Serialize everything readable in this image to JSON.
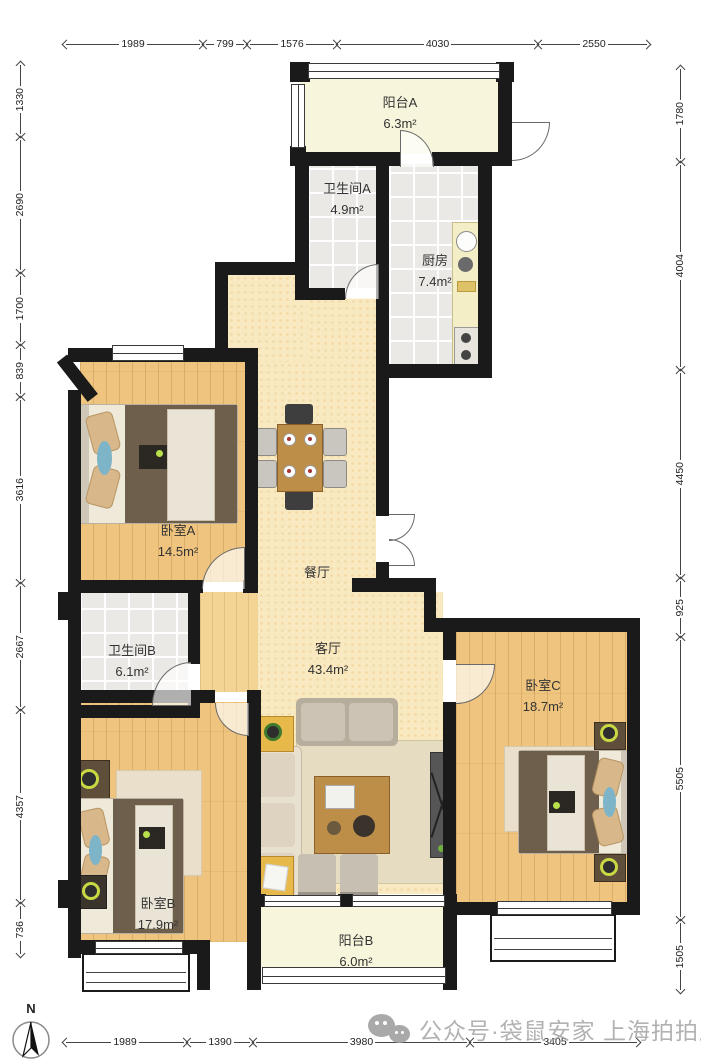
{
  "watermark": {
    "text": "公众号·袋鼠安家 上海拍拍屋"
  },
  "compass": {
    "label": "N"
  },
  "rooms": {
    "balcony_a": {
      "name": "阳台A",
      "area": "6.3m²"
    },
    "bath_a": {
      "name": "卫生间A",
      "area": "4.9m²"
    },
    "kitchen": {
      "name": "厨房",
      "area": "7.4m²"
    },
    "bedroom_a": {
      "name": "卧室A",
      "area": "14.5m²"
    },
    "dining": {
      "name": "餐厅",
      "area": ""
    },
    "bath_b": {
      "name": "卫生间B",
      "area": "6.1m²"
    },
    "living": {
      "name": "客厅",
      "area": "43.4m²"
    },
    "bedroom_c": {
      "name": "卧室C",
      "area": "18.7m²"
    },
    "bedroom_b": {
      "name": "卧室B",
      "area": "17.9m²"
    },
    "balcony_b": {
      "name": "阳台B",
      "area": "6.0m²"
    }
  },
  "dimensions": {
    "top": [
      {
        "value": "1989",
        "from": 63,
        "to": 203
      },
      {
        "value": "799",
        "from": 203,
        "to": 247
      },
      {
        "value": "1576",
        "from": 247,
        "to": 337
      },
      {
        "value": "4030",
        "from": 337,
        "to": 538
      },
      {
        "value": "2550",
        "from": 538,
        "to": 650
      }
    ],
    "bottom": [
      {
        "value": "1989",
        "from": 63,
        "to": 187
      },
      {
        "value": "1390",
        "from": 187,
        "to": 253
      },
      {
        "value": "3980",
        "from": 253,
        "to": 470
      },
      {
        "value": "3405",
        "from": 470,
        "to": 640
      }
    ],
    "left": [
      {
        "value": "1330",
        "from": 62,
        "to": 137
      },
      {
        "value": "2690",
        "from": 137,
        "to": 273
      },
      {
        "value": "1700",
        "from": 273,
        "to": 345
      },
      {
        "value": "839",
        "from": 345,
        "to": 397
      },
      {
        "value": "3616",
        "from": 397,
        "to": 583
      },
      {
        "value": "2667",
        "from": 583,
        "to": 710
      },
      {
        "value": "4357",
        "from": 710,
        "to": 903
      },
      {
        "value": "736",
        "from": 903,
        "to": 957
      }
    ],
    "right": [
      {
        "value": "1780",
        "from": 66,
        "to": 162
      },
      {
        "value": "4004",
        "from": 162,
        "to": 370
      },
      {
        "value": "4450",
        "from": 370,
        "to": 578
      },
      {
        "value": "925",
        "from": 578,
        "to": 637
      },
      {
        "value": "5505",
        "from": 637,
        "to": 920
      },
      {
        "value": "1505",
        "from": 920,
        "to": 993
      }
    ]
  },
  "colors": {
    "wall": "#1a1a1a",
    "wood_floor": "#eec47e",
    "tile_floor": "#eae9e6",
    "cream_floor": "#f9e9c1",
    "balcony_floor": "#f7f5db",
    "label_text": "#333333",
    "dimension_text": "#222222",
    "watermark_gray": "#a8a8a8",
    "lamp_ring_green": "#c8d943",
    "table_wood": "#bd8e47"
  }
}
